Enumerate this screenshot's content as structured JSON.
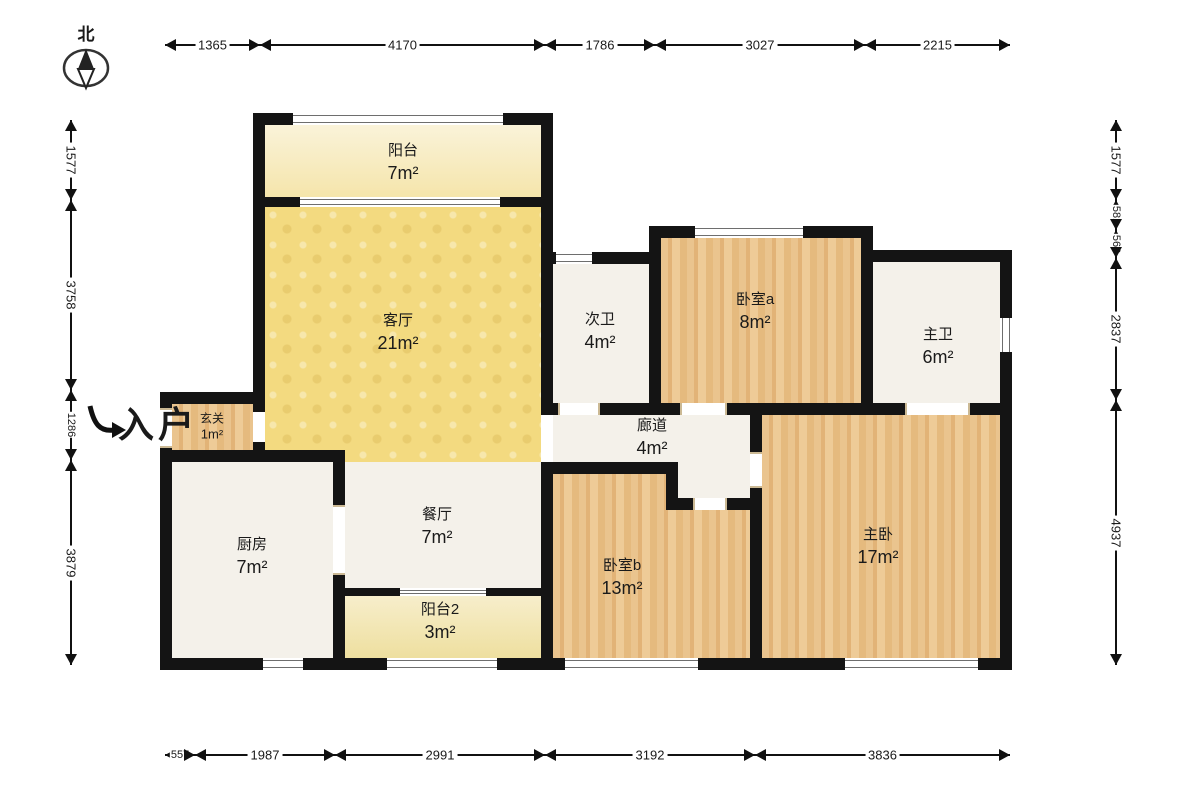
{
  "compass": {
    "north_label": "北"
  },
  "entry": {
    "label": "入户"
  },
  "rooms": {
    "balcony1": {
      "name": "阳台",
      "area": "7m²"
    },
    "living": {
      "name": "客厅",
      "area": "21m²"
    },
    "bath2": {
      "name": "次卫",
      "area": "4m²"
    },
    "bedroom_a": {
      "name": "卧室a",
      "area": "8m²"
    },
    "bath_master": {
      "name": "主卫",
      "area": "6m²"
    },
    "foyer": {
      "name": "玄关",
      "area": "1m²"
    },
    "corridor": {
      "name": "廊道",
      "area": "4m²"
    },
    "kitchen": {
      "name": "厨房",
      "area": "7m²"
    },
    "dining": {
      "name": "餐厅",
      "area": "7m²"
    },
    "balcony2": {
      "name": "阳台2",
      "area": "3m²"
    },
    "bedroom_b": {
      "name": "卧室b",
      "area": "13m²"
    },
    "master": {
      "name": "主卧",
      "area": "17m²"
    }
  },
  "dims": {
    "top": [
      "1365",
      "4170",
      "1786",
      "3027",
      "2215"
    ],
    "bottom": [
      "557",
      "1987",
      "2991",
      "3192",
      "3836"
    ],
    "left": [
      "1577",
      "3758",
      "1286",
      "3879"
    ],
    "right": [
      "1577",
      "581",
      "568",
      "2837",
      "4937"
    ]
  },
  "colors": {
    "wall": "#141414",
    "living_yellow": "#f3da80",
    "wood": "#e5ba7e",
    "balcony_cream": "#f5e5ab",
    "white_room": "#f4f1ea"
  }
}
